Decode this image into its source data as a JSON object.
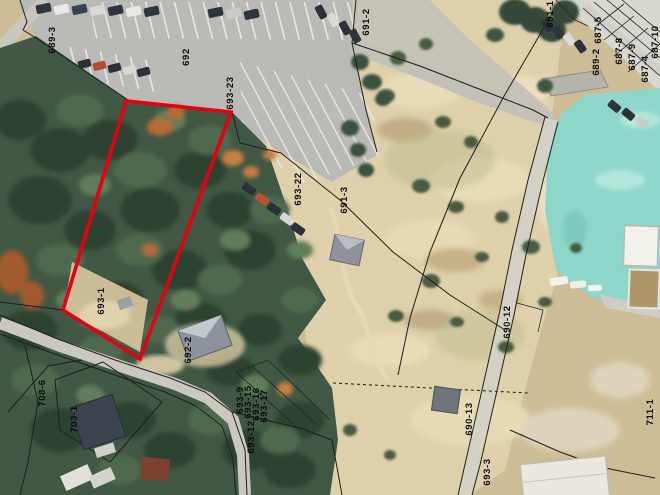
{
  "map": {
    "highlight": {
      "parcel": "693-1",
      "color": "#e60012",
      "points": "126,101 231,112 140,359 63,310"
    },
    "boundary_color": "#1f1f1f",
    "label_color": "#0c0c0c",
    "parcel_labels": [
      {
        "text": "689-3",
        "x": 55,
        "y": 40
      },
      {
        "text": "692",
        "x": 189,
        "y": 57
      },
      {
        "text": "693-23",
        "x": 233,
        "y": 93
      },
      {
        "text": "691-2",
        "x": 369,
        "y": 22
      },
      {
        "text": "691-1",
        "x": 553,
        "y": 14
      },
      {
        "text": "687-5",
        "x": 601,
        "y": 30
      },
      {
        "text": "689-2",
        "x": 599,
        "y": 62
      },
      {
        "text": "687-8",
        "x": 622,
        "y": 51
      },
      {
        "text": "687-9",
        "x": 635,
        "y": 57
      },
      {
        "text": "687-4",
        "x": 648,
        "y": 69
      },
      {
        "text": "687-10",
        "x": 658,
        "y": 42
      },
      {
        "text": "693-22",
        "x": 301,
        "y": 189
      },
      {
        "text": "691-3",
        "x": 347,
        "y": 200
      },
      {
        "text": "693-1",
        "x": 104,
        "y": 301
      },
      {
        "text": "703-1",
        "x": 77,
        "y": 419
      },
      {
        "text": "708-6",
        "x": 45,
        "y": 393
      },
      {
        "text": "692-2",
        "x": 191,
        "y": 350
      },
      {
        "text": "693-9",
        "x": 243,
        "y": 400
      },
      {
        "text": "693-15",
        "x": 251,
        "y": 402
      },
      {
        "text": "693-16",
        "x": 259,
        "y": 404
      },
      {
        "text": "693-17",
        "x": 267,
        "y": 406
      },
      {
        "text": "693-12",
        "x": 254,
        "y": 437
      },
      {
        "text": "690-12",
        "x": 510,
        "y": 322
      },
      {
        "text": "690-13",
        "x": 472,
        "y": 419
      },
      {
        "text": "693-3",
        "x": 490,
        "y": 472
      },
      {
        "text": "711-1",
        "x": 653,
        "y": 412
      }
    ]
  }
}
